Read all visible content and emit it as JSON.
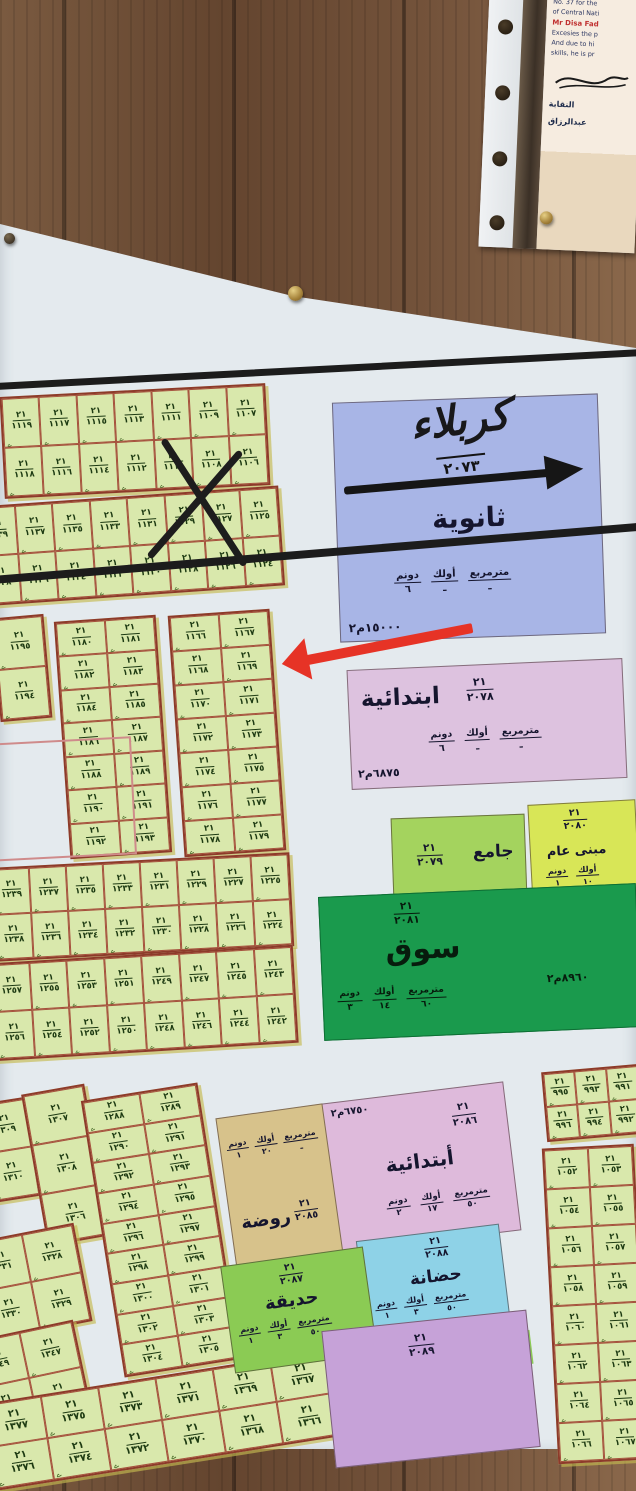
{
  "certificate": {
    "lines_top": [
      "No. 37 for the",
      "of Central Nati"
    ],
    "name": "Mr Disa Fad",
    "body": [
      "Excesies the p",
      "And due to hi",
      "skills, he is pr"
    ],
    "arabic": [
      "النقابة",
      "عبدالرزاق"
    ]
  },
  "map": {
    "sector": "٢١",
    "squiggle": "ے",
    "handwritten": {
      "city": "كربلاء",
      "block": "٢٠٧٣"
    },
    "unit_headers": [
      "مترمربع",
      "أولك",
      "دونم"
    ],
    "facilities": {
      "secondary": {
        "label": "ثانوية",
        "block": "٢٠٧٣",
        "values": [
          "ـ",
          "ـ",
          "٦"
        ],
        "area": "١٥٠٠٠م٢",
        "color": "#a8b5e6"
      },
      "primary_2078": {
        "label": "ابتدائية",
        "block": "٢٠٧٨",
        "values": [
          "ـ",
          "ـ",
          "٦"
        ],
        "area": "٦٨٧٥م٢",
        "color": "#ddc2df"
      },
      "mosque": {
        "label": "جامع",
        "block": "٢٠٧٩",
        "color": "#a4d35e"
      },
      "public_building": {
        "label": "مبنى عام",
        "block": "٢٠٨٠",
        "headers": [
          "أولك",
          "دونم"
        ],
        "values": [
          "١٠",
          "١"
        ],
        "color": "#d8e657"
      },
      "market": {
        "label": "سوق",
        "block": "٢٠٨١",
        "values": [
          "٦٠",
          "١٤",
          "٣"
        ],
        "area": "٨٩٦٠م٢",
        "color": "#1a9a4d"
      },
      "primary_2086": {
        "label": "أبتدائية",
        "block": "٢٠٨٦",
        "values": [
          "٥٠",
          "١٧",
          "٢"
        ],
        "area": "٦٧٥٠م٢",
        "color": "#debadb"
      },
      "kindergarten": {
        "label": "روضة",
        "block": "٢٠٨٥",
        "values": [
          "ـ",
          "٢٠",
          "١"
        ],
        "color": "#d7c28b"
      },
      "nursery": {
        "label": "حضانة",
        "block": "٢٠٨٨",
        "values": [
          "٥٠",
          "٣",
          "١"
        ],
        "color": "#8ed2e7"
      },
      "garden": {
        "label": "حديقة",
        "block": "٢٠٨٧",
        "values": [
          "٥٠",
          "٣",
          "١"
        ],
        "color": "#8bcb54"
      },
      "block_2089": {
        "label": "",
        "block": "٢٠٨٩",
        "color": "#c6a2d8"
      }
    },
    "plot_blocks": {
      "a": [
        [
          "١١١٩",
          "١١١٧",
          "١١١٥",
          "١١١٣",
          "١١١١",
          "١١٠٩",
          "١١٠٧"
        ],
        [
          "١١١٨",
          "١١١٦",
          "١١١٤",
          "١١١٢",
          "١١١٠",
          "١١٠٨",
          "١١٠٦"
        ]
      ],
      "b": [
        [
          "١١٣٩",
          "١١٣٧",
          "١١٣٥",
          "١١٣٣",
          "١١٣١",
          "١١٢٩",
          "١١٢٧",
          "١١٢٥"
        ],
        [
          "١١٣٨",
          "١١٣٦",
          "١١٣٤",
          "١١٣٢",
          "١١٣٠",
          "١١٢٨",
          "١١٢٦",
          "١١٢٤"
        ]
      ],
      "c": [
        [
          "١١٩٥"
        ],
        [
          "١١٩٤"
        ]
      ],
      "d": [
        [
          "١١٨٠",
          "١١٨١"
        ],
        [
          "١١٨٢",
          "١١٨٣"
        ],
        [
          "١١٨٤",
          "١١٨٥"
        ],
        [
          "١١٨٦",
          "١١٨٧"
        ],
        [
          "١١٨٨",
          "١١٨٩"
        ],
        [
          "١١٩٠",
          "١١٩١"
        ],
        [
          "١١٩٢",
          "١١٩٣"
        ]
      ],
      "e": [
        [
          "١١٦٦",
          "١١٦٧"
        ],
        [
          "١١٦٨",
          "١١٦٩"
        ],
        [
          "١١٧٠",
          "١١٧١"
        ],
        [
          "١١٧٢",
          "١١٧٣"
        ],
        [
          "١١٧٤",
          "١١٧٥"
        ],
        [
          "١١٧٦",
          "١١٧٧"
        ],
        [
          "١١٧٨",
          "١١٧٩"
        ]
      ],
      "f": [
        [
          "١٢٣٩",
          "١٢٣٧",
          "١٢٣٥",
          "١٢٣٣",
          "١٢٣١",
          "١٢٢٩",
          "١٢٢٧",
          "١٢٢٥"
        ],
        [
          "١٢٣٨",
          "١٢٣٦",
          "١٢٣٤",
          "١٢٣٢",
          "١٢٣٠",
          "١٢٢٨",
          "١٢٢٦",
          "١٢٢٤"
        ]
      ],
      "g": [
        [
          "١٢٥٧",
          "١٢٥٥",
          "١٢٥٣",
          "١٢٥١",
          "١٢٤٩",
          "١٢٤٧",
          "١٢٤٥",
          "١٢٤٣"
        ],
        [
          "١٢٥٦",
          "١٢٥٤",
          "١٢٥٢",
          "١٢٥٠",
          "١٢٤٨",
          "١٢٤٦",
          "١٢٤٤",
          "١٢٤٢"
        ]
      ],
      "h1": [
        [
          "١٣٠٩"
        ],
        [
          "١٣١٠"
        ]
      ],
      "h2": [
        [
          "١٣٠٧"
        ],
        [
          "١٣٠٨"
        ],
        [
          "١٣٠٦"
        ]
      ],
      "i": [
        [
          "١٢٨٨",
          "١٢٨٩"
        ],
        [
          "١٢٩٠",
          "١٢٩١"
        ],
        [
          "١٢٩٢",
          "١٢٩٣"
        ],
        [
          "١٢٩٤",
          "١٢٩٥"
        ],
        [
          "١٢٩٦",
          "١٢٩٧"
        ],
        [
          "١٢٩٨",
          "١٢٩٩"
        ],
        [
          "١٣٠٠",
          "١٣٠١"
        ],
        [
          "١٣٠٢",
          "١٣٠٣"
        ],
        [
          "١٣٠٤",
          "١٣٠٥"
        ]
      ],
      "j": [
        [
          "١٣٣١",
          "١٣٢٨"
        ],
        [
          "١٣٣٠",
          "١٣٢٩"
        ]
      ],
      "k": [
        [
          "١٣٤٩",
          "١٣٤٧"
        ],
        [
          "١٣٥٠",
          "١٣٤٨"
        ]
      ],
      "l": [
        [
          "١٣٧٧",
          "١٣٧٥",
          "١٣٧٣",
          "١٣٧١",
          "١٣٦٩",
          "١٣٦٧"
        ],
        [
          "١٣٧٦",
          "١٣٧٤",
          "١٣٧٢",
          "١٣٧٠",
          "١٣٦٨",
          "١٣٦٦"
        ]
      ],
      "r1": [
        [
          "٩٩٥",
          "٩٩٣",
          "٩٩١"
        ],
        [
          "٩٩٦",
          "٩٩٤",
          "٩٩٢"
        ]
      ],
      "r2": [
        [
          "١٠٥٢",
          "١٠٥٣"
        ],
        [
          "١٠٥٤",
          "١٠٥٥"
        ],
        [
          "١٠٥٦",
          "١٠٥٧"
        ],
        [
          "١٠٥٨",
          "١٠٥٩"
        ],
        [
          "١٠٦٠",
          "١٠٦١"
        ],
        [
          "١٠٦٢",
          "١٠٦٣"
        ],
        [
          "١٠٦٤",
          "١٠٦٥"
        ],
        [
          "١٠٦٦",
          "١٠٦٧"
        ]
      ]
    }
  },
  "annotations": {
    "red_arrow_color": "#e63326",
    "x_mark_color": "#1d1d1d",
    "road_color": "#1c1c1c"
  }
}
